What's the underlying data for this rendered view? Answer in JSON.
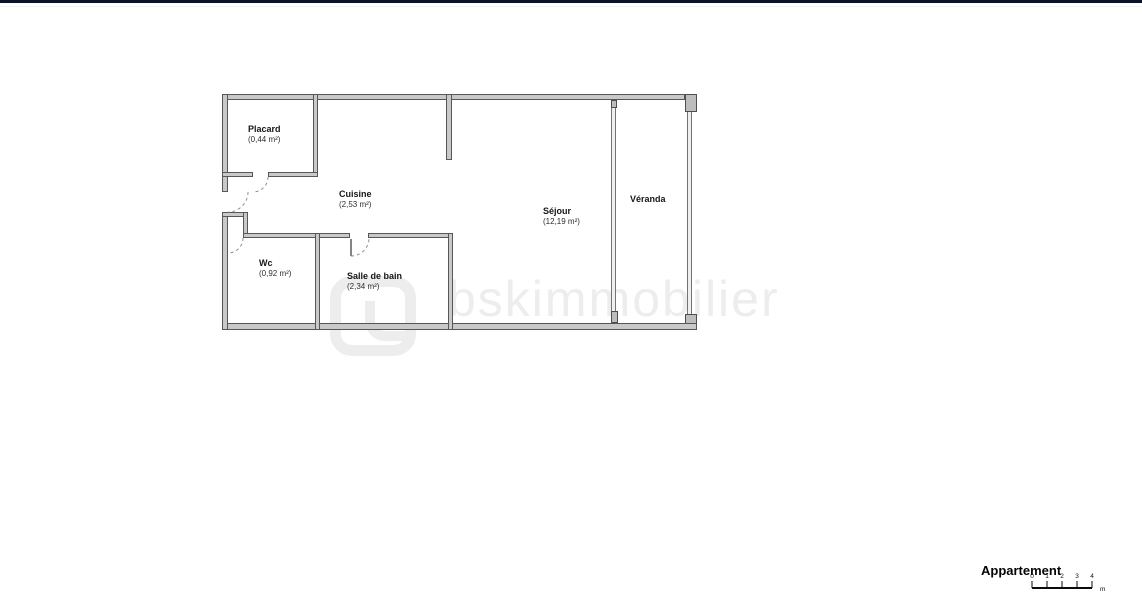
{
  "colors": {
    "top_bar": "#0c1226",
    "wall_fill": "#c9c9c9",
    "wall_edge": "#575757",
    "label_text": "#1c1c1c",
    "watermark": "#ededed"
  },
  "floor_plan": {
    "rooms": [
      {
        "name": "Placard",
        "area": "(0,44 m²)"
      },
      {
        "name": "Cuisine",
        "area": "(2,53 m²)"
      },
      {
        "name": "Wc",
        "area": "(0,92 m²)"
      },
      {
        "name": "Salle de bain",
        "area": "(2,34 m²)"
      },
      {
        "name": "Séjour",
        "area": "(12,19 m²)"
      },
      {
        "name": "Véranda"
      }
    ]
  },
  "watermark": {
    "text": "bskimmobilier"
  },
  "title_block": {
    "title": "Appartement",
    "scale_labels": [
      "0",
      "1",
      "2",
      "3",
      "4"
    ],
    "unit": "m"
  }
}
